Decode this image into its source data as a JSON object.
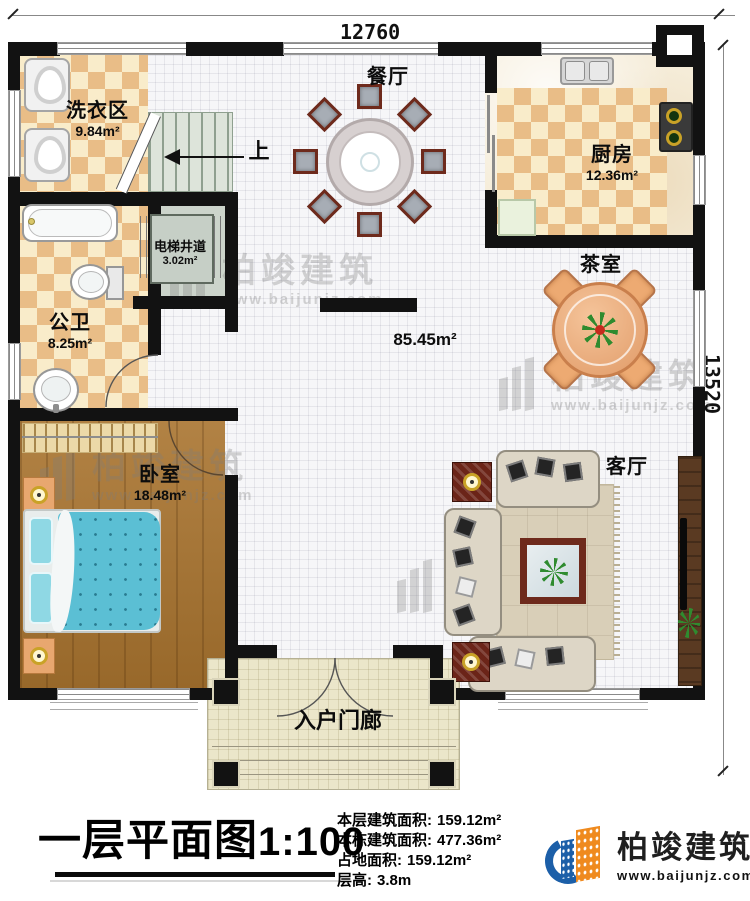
{
  "dimensions": {
    "top": "12760",
    "right": "13520"
  },
  "rooms": {
    "laundry": {
      "name": "洗衣区",
      "area": "9.84m²"
    },
    "dining": {
      "name": "餐厅"
    },
    "kitchen": {
      "name": "厨房",
      "area": "12.36m²"
    },
    "elevator": {
      "name": "电梯井道",
      "area": "3.02m²"
    },
    "bathroom": {
      "name": "公卫",
      "area": "8.25m²"
    },
    "tea": {
      "name": "茶室"
    },
    "hall": {
      "area": "85.45m²"
    },
    "bedroom": {
      "name": "卧室",
      "area": "18.48m²"
    },
    "living": {
      "name": "客厅"
    },
    "porch": {
      "name": "入户门廊"
    },
    "stairs": {
      "direction": "上"
    }
  },
  "watermark": {
    "brand": "柏竣建筑",
    "url": "www.baijunjz.com"
  },
  "footer": {
    "title": "一层平面图",
    "scale": "1:100",
    "stats": [
      {
        "label": "本层建筑面积:",
        "value": "159.12m²"
      },
      {
        "label": "本栋建筑面积:",
        "value": "477.36m²"
      },
      {
        "label": "占地面积:",
        "value": "159.12m²"
      },
      {
        "label": "层高:",
        "value": "3.8m"
      }
    ],
    "logo": {
      "brand": "柏竣建筑",
      "url": "www.baijunjz.com"
    }
  },
  "colors": {
    "wall": "#121212",
    "checker": "#e9bd87",
    "wood": "#a9742f",
    "logo_blue": "#1c5fa8",
    "logo_orange": "#ef8a1e"
  }
}
